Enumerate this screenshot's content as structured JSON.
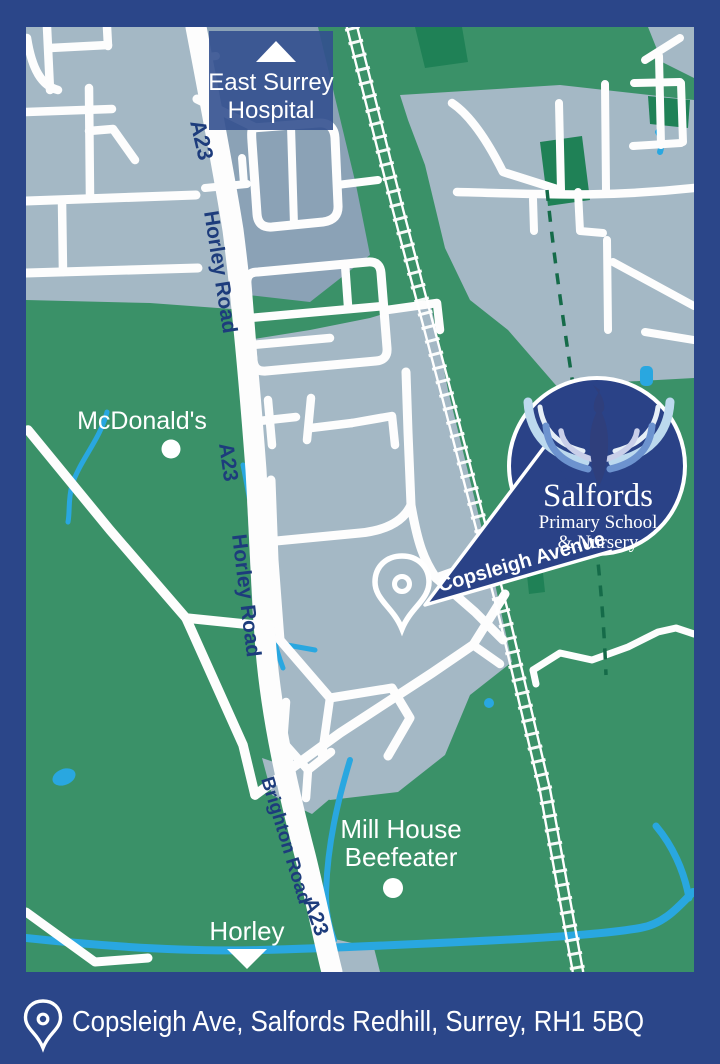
{
  "map": {
    "poi": {
      "hospital_line1": "East Surrey",
      "hospital_line2": "Hospital",
      "mcdonalds": "McDonald's",
      "mill_house_line1": "Mill House",
      "mill_house_line2": "Beefeater",
      "horley": "Horley"
    },
    "roads": {
      "a23": "A23",
      "horley_road": "Horley Road",
      "brighton_road": "Brighton Road",
      "copsleigh_avenue": "Copsleigh Avenue"
    },
    "badge": {
      "school_name": "Salfords",
      "subtitle_line1": "Primary School",
      "subtitle_line2": "& Nursery"
    },
    "colors": {
      "frame_navy": "#2b4689",
      "land_green": "#3a9168",
      "dark_green_patch": "#1f8156",
      "urban_grey": "#a4b8c5",
      "hospital_grey": "#8ba2b6",
      "water_blue": "#29a7e0",
      "road_white": "#fdfdfd",
      "road_label_navy": "#1d3c7c",
      "badge_navy": "#2a4287",
      "footpath_green": "#156b49"
    }
  },
  "footer": {
    "address": "Copsleigh Ave, Salfords Redhill, Surrey, RH1 5BQ"
  }
}
